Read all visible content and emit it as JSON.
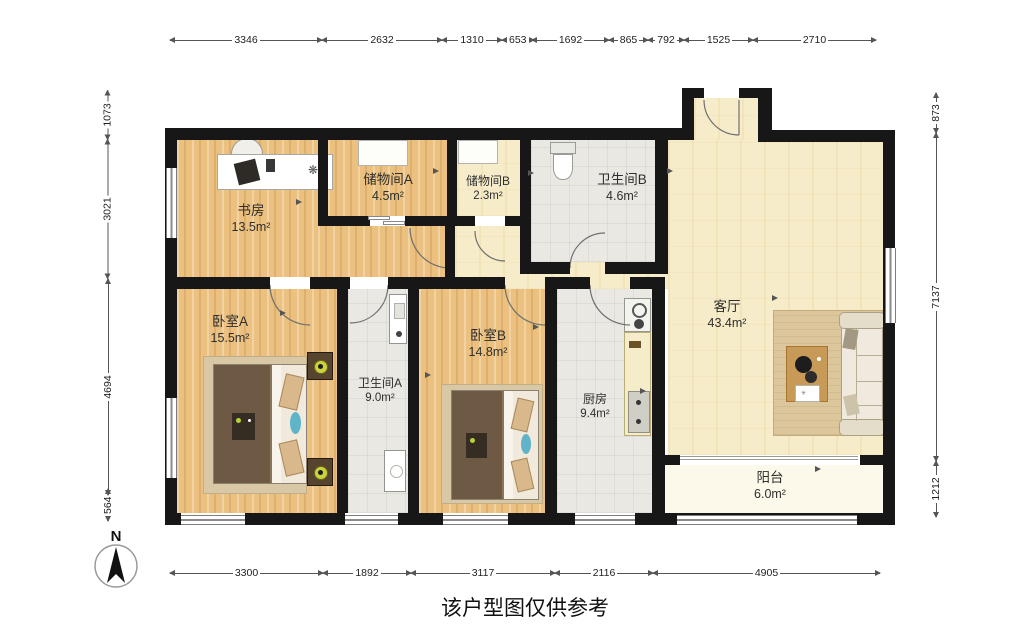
{
  "caption": "该户型图仅供参考",
  "watermark": {
    "main": "LIANJIA",
    "sub": ".com"
  },
  "compass": {
    "label": "N"
  },
  "rooms": [
    {
      "id": "shufang",
      "name": "书房",
      "area": "13.5m²"
    },
    {
      "id": "chuwujian_a",
      "name": "储物间A",
      "area": "4.5m²"
    },
    {
      "id": "chuwujian_b",
      "name": "储物间B",
      "area": "2.3m²"
    },
    {
      "id": "weishengjian_b",
      "name": "卫生间B",
      "area": "4.6m²"
    },
    {
      "id": "keting",
      "name": "客厅",
      "area": "43.4m²"
    },
    {
      "id": "woshi_a",
      "name": "卧室A",
      "area": "15.5m²"
    },
    {
      "id": "weishengjian_a",
      "name": "卫生间A",
      "area": "9.0m²"
    },
    {
      "id": "woshi_b",
      "name": "卧室B",
      "area": "14.8m²"
    },
    {
      "id": "chufang",
      "name": "厨房",
      "area": "9.4m²"
    },
    {
      "id": "yangtai",
      "name": "阳台",
      "area": "6.0m²"
    }
  ],
  "dims": {
    "top": [
      "3346",
      "2632",
      "1310",
      "653",
      "1692",
      "865",
      "792",
      "1525",
      "2710"
    ],
    "bottom": [
      "3300",
      "1892",
      "3117",
      "2116",
      "4905"
    ],
    "left": [
      "1073",
      "3021",
      "4694",
      "564"
    ],
    "right": [
      "873",
      "7137",
      "1212"
    ]
  },
  "colors": {
    "wall": "#171717",
    "wood_floor": "#ecc07e",
    "tile_yellow": "#f7ecca",
    "tile_gray": "#e9e8e3",
    "balcony_floor": "#fcf8ea",
    "rug": "#d9c8a6",
    "duvet": "#6e5a44",
    "accent_teal": "#5fb4c9",
    "lamp_yellow": "#ccd23e"
  }
}
